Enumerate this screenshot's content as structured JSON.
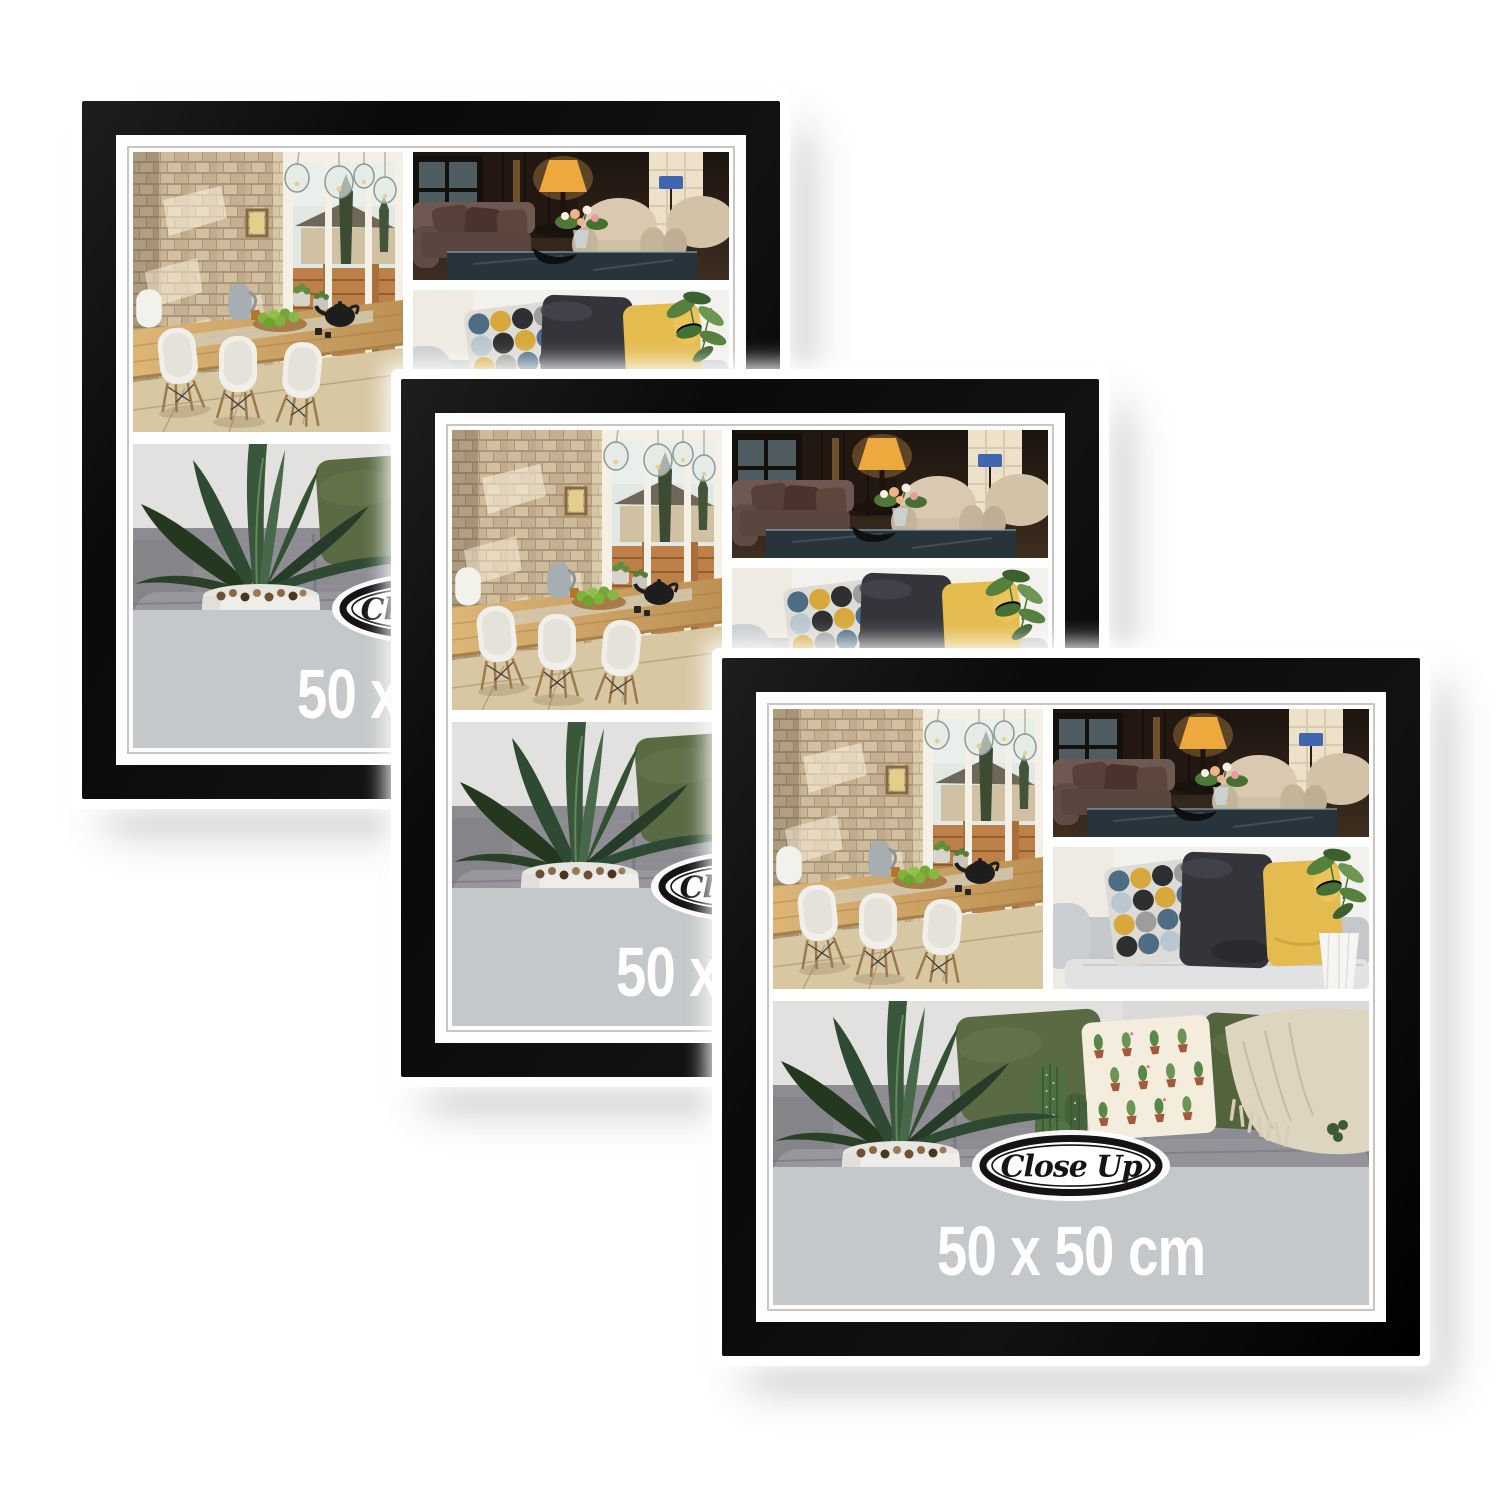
{
  "image": {
    "type": "product-photo",
    "description": "Three identical black square collage picture frames shown overlapping diagonally on a white background"
  },
  "product": {
    "brand": "Close Up",
    "size_label": "50 x 50 cm",
    "frame_count": 3,
    "frame_color_name": "black",
    "mat_color_name": "white"
  },
  "frames": [
    {
      "position": "back"
    },
    {
      "position": "middle"
    },
    {
      "position": "front"
    }
  ],
  "collage_photos": [
    {
      "name": "dining-room",
      "description": "Sunlit dining room with brick wall, glass pendant lamps, long wooden table with green apples and teapot, white shell chairs"
    },
    {
      "name": "living-room",
      "description": "Dark cozy lounge with amber lamp, brown leather sofa, cream armchairs and a flower bouquet on a glass table"
    },
    {
      "name": "sofa-pillows",
      "description": "Light gray sofa with circle-patterned, charcoal and yellow cushions beside a green plant in a white vase"
    },
    {
      "name": "plant-sofa",
      "description": "Agave plant in a white pebble-topped pot, cacti, cactus-print cushion, olive pillows and a beige fringed throw on a gray sofa"
    }
  ],
  "colors": {
    "background": "#ffffff",
    "frame_black": "#0b0b0b",
    "mat_white": "#fdfdfd",
    "mat_pinstripe": "#c6c6c3",
    "band_gray": "#c5c8ca",
    "size_text": "#ffffff",
    "logo_ink": "#141414"
  }
}
